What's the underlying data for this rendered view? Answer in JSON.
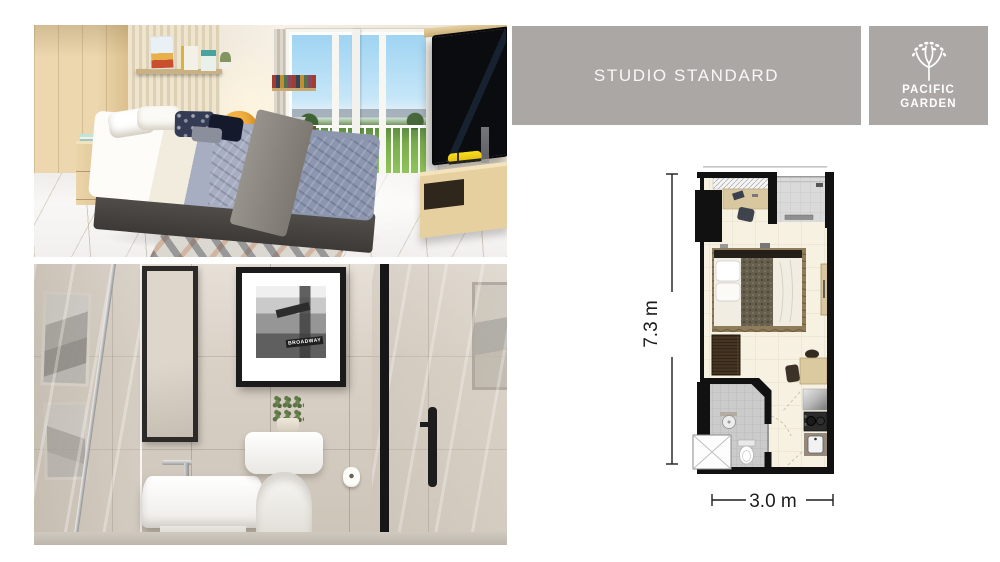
{
  "header": {
    "title": "STUDIO STANDARD"
  },
  "logo": {
    "line1": "PACIFIC",
    "line2": "GARDEN",
    "icon": "tree-icon"
  },
  "floorplan": {
    "height_label": "7.3 m",
    "width_label": "3.0 m"
  },
  "bathroom_art": {
    "poster_text": "BROADWAY"
  },
  "colors": {
    "panel_gray": "#aba7a5",
    "panel_text": "#f8f7f5",
    "wall_black": "#111111",
    "floor_cream": "#f7f1e2",
    "bath_tile_gray": "#cccccc",
    "dimension_text": "#1c1c1c"
  }
}
